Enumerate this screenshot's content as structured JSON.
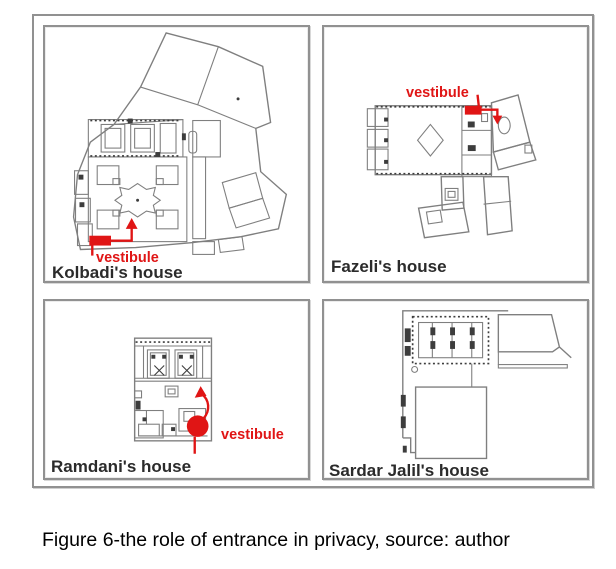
{
  "figure": {
    "caption": "Figure 6-the role of entrance in privacy, source: author",
    "panels": [
      {
        "id": "kolbadi",
        "label": "Kolbadi's house",
        "annotation": "vestibule"
      },
      {
        "id": "fazeli",
        "label": "Fazeli's house",
        "annotation": "vestibule"
      },
      {
        "id": "ramdani",
        "label": "Ramdani's house",
        "annotation": "vestibule"
      },
      {
        "id": "sardar-jalil",
        "label": "Sardar Jalil's house"
      }
    ]
  },
  "colors": {
    "annotation_red": "#e01515",
    "plan_line": "#7f7f7f",
    "plan_line_dark": "#3d3d3d",
    "panel_border": "#919191",
    "label_text": "#2b2b2b",
    "caption_text": "#000000"
  }
}
